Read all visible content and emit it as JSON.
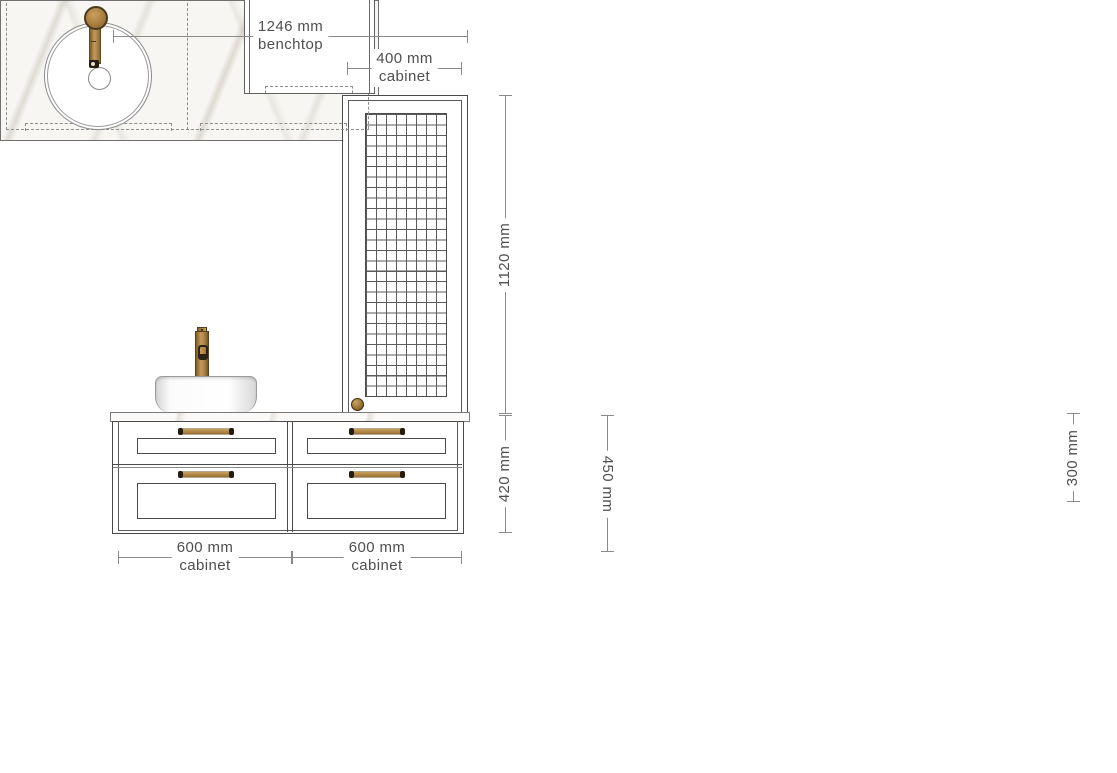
{
  "drawing": {
    "type": "bathroom-vanity-cabinet-drawing",
    "views": {
      "left": "front-elevation",
      "right": "plan"
    }
  },
  "dims": {
    "benchtop_width": {
      "value": "1246 mm",
      "label": "benchtop"
    },
    "tall_cabinet_width": {
      "value": "400 mm",
      "label": "cabinet"
    },
    "left_cabinet_width": {
      "value": "600 mm",
      "label": "cabinet"
    },
    "right_cabinet_width": {
      "value": "600 mm",
      "label": "cabinet"
    },
    "tall_cabinet_height": {
      "value": "1120 mm"
    },
    "vanity_height": {
      "value": "420 mm"
    },
    "benchtop_depth": {
      "value": "450 mm"
    },
    "tall_cabinet_depth": {
      "value": "300 mm"
    }
  },
  "colors": {
    "outline": "#4a4a4a",
    "dim_line": "#8a8a8a",
    "dim_text": "#4f4f4f",
    "brass": "#a87e3f",
    "brass_dark": "#5f4722",
    "marble": "#f7f6f3",
    "white": "#ffffff"
  }
}
